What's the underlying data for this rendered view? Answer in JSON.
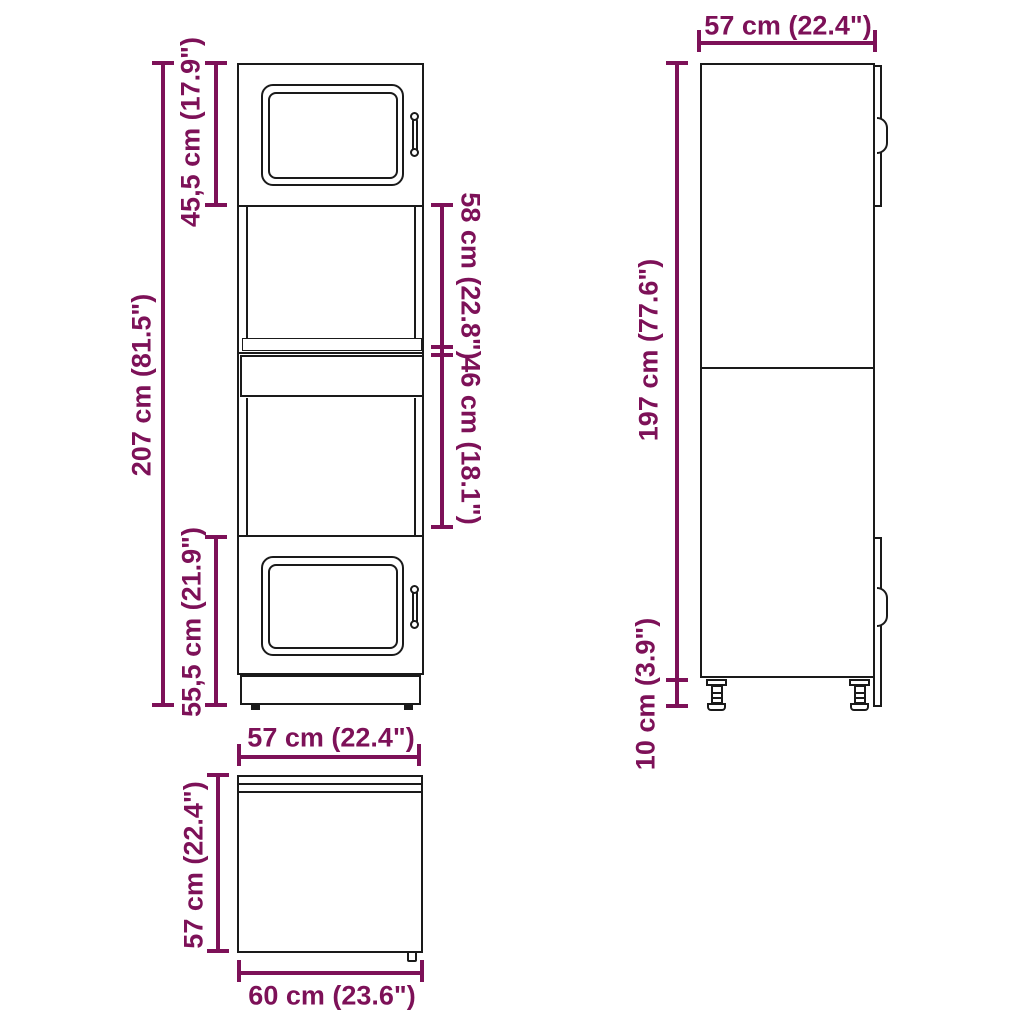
{
  "diagram": {
    "type": "furniture-dimension-diagram",
    "subject": "tall-oven-kitchen-cabinet",
    "accent_color": "#7d1158",
    "line_color": "#1a1a1a",
    "background": "#ffffff",
    "views": {
      "front": "front-view",
      "side": "side-view",
      "top": "top-view"
    }
  },
  "dimensions": {
    "front_total_height": "207 cm (81.5\")",
    "front_top_door_height": "45,5 cm (17.9\")",
    "front_bottom_door_height": "55,5 cm (21.9\")",
    "front_upper_opening_height": "58 cm (22.8\")",
    "front_lower_opening_height": "46 cm (18.1\")",
    "side_depth": "57 cm (22.4\")",
    "side_body_height": "197 cm (77.6\")",
    "side_leg_height": "10 cm (3.9\")",
    "top_view_width": "57 cm (22.4\")",
    "top_view_depth": "57 cm (22.4\")",
    "top_view_total_depth": "60 cm (23.6\")"
  }
}
